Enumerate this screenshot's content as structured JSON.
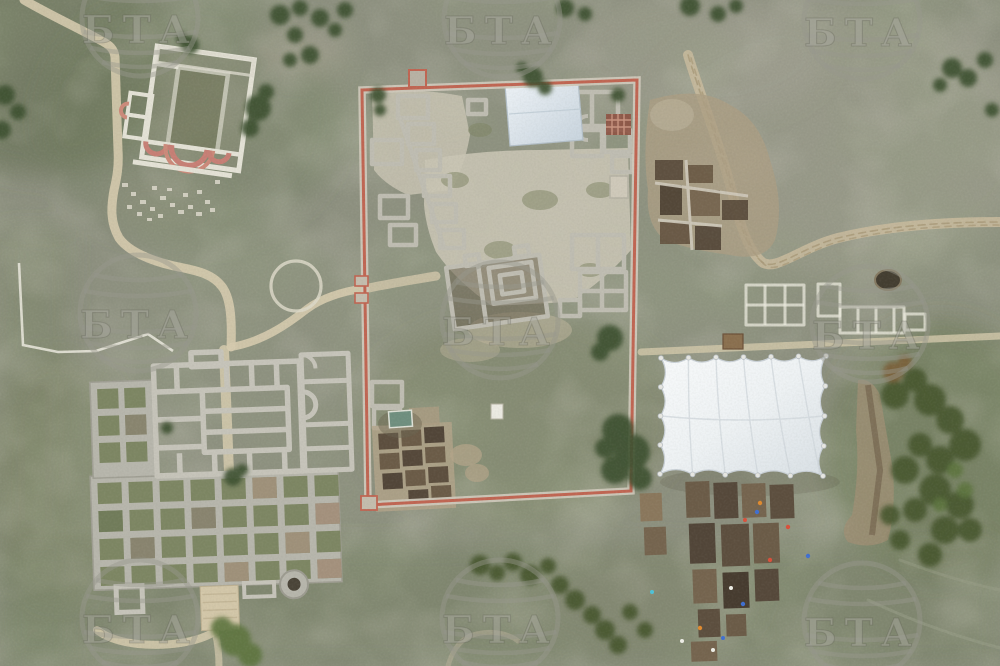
{
  "watermark": {
    "text": "БТА",
    "count": 9,
    "style": "semi-transparent globe logo with Cyrillic letters"
  },
  "scene": {
    "type": "aerial-drone-photograph",
    "description": "Top-down aerial photo of an archaeological site: ruined basilica with red apses (top left), large walled compound with excavated foundations and a pale blue protective roof (center), white scalloped excavation tent and open trench grids with workers (right), and a large grid-plan building foundation complex (bottom left), all set in mottled grey-green grassland crossed by sandy paths and a curving dirt track."
  },
  "colors": {
    "grass_base": "#8e9180",
    "grass_dark": "#5e6a4c",
    "grass_pale": "#a8a699",
    "stone_pavement": "#c9c4b4",
    "ruin_wall": "#bfbdb2",
    "white_wall": "#e8e6da",
    "enclosure_wall_red": "#c06552",
    "apse_red": "#c77f75",
    "path_tan": "#d6cbae",
    "dirt_track": "#c9bb9e",
    "trench_brown": "#5c4e3e",
    "excavated_earth": "#ab9d83",
    "tent_white": "#f5f7f9",
    "roof_pale_blue": "#dbe4ec",
    "shed_green": "#6f8f7f",
    "tree_green": "#3e5130",
    "watermark_grey": "#a8a89e",
    "people_marker_colors": [
      "#d94f3a",
      "#3f6fd1",
      "#e08a2e",
      "#efefe8",
      "#4fc3d9"
    ]
  }
}
